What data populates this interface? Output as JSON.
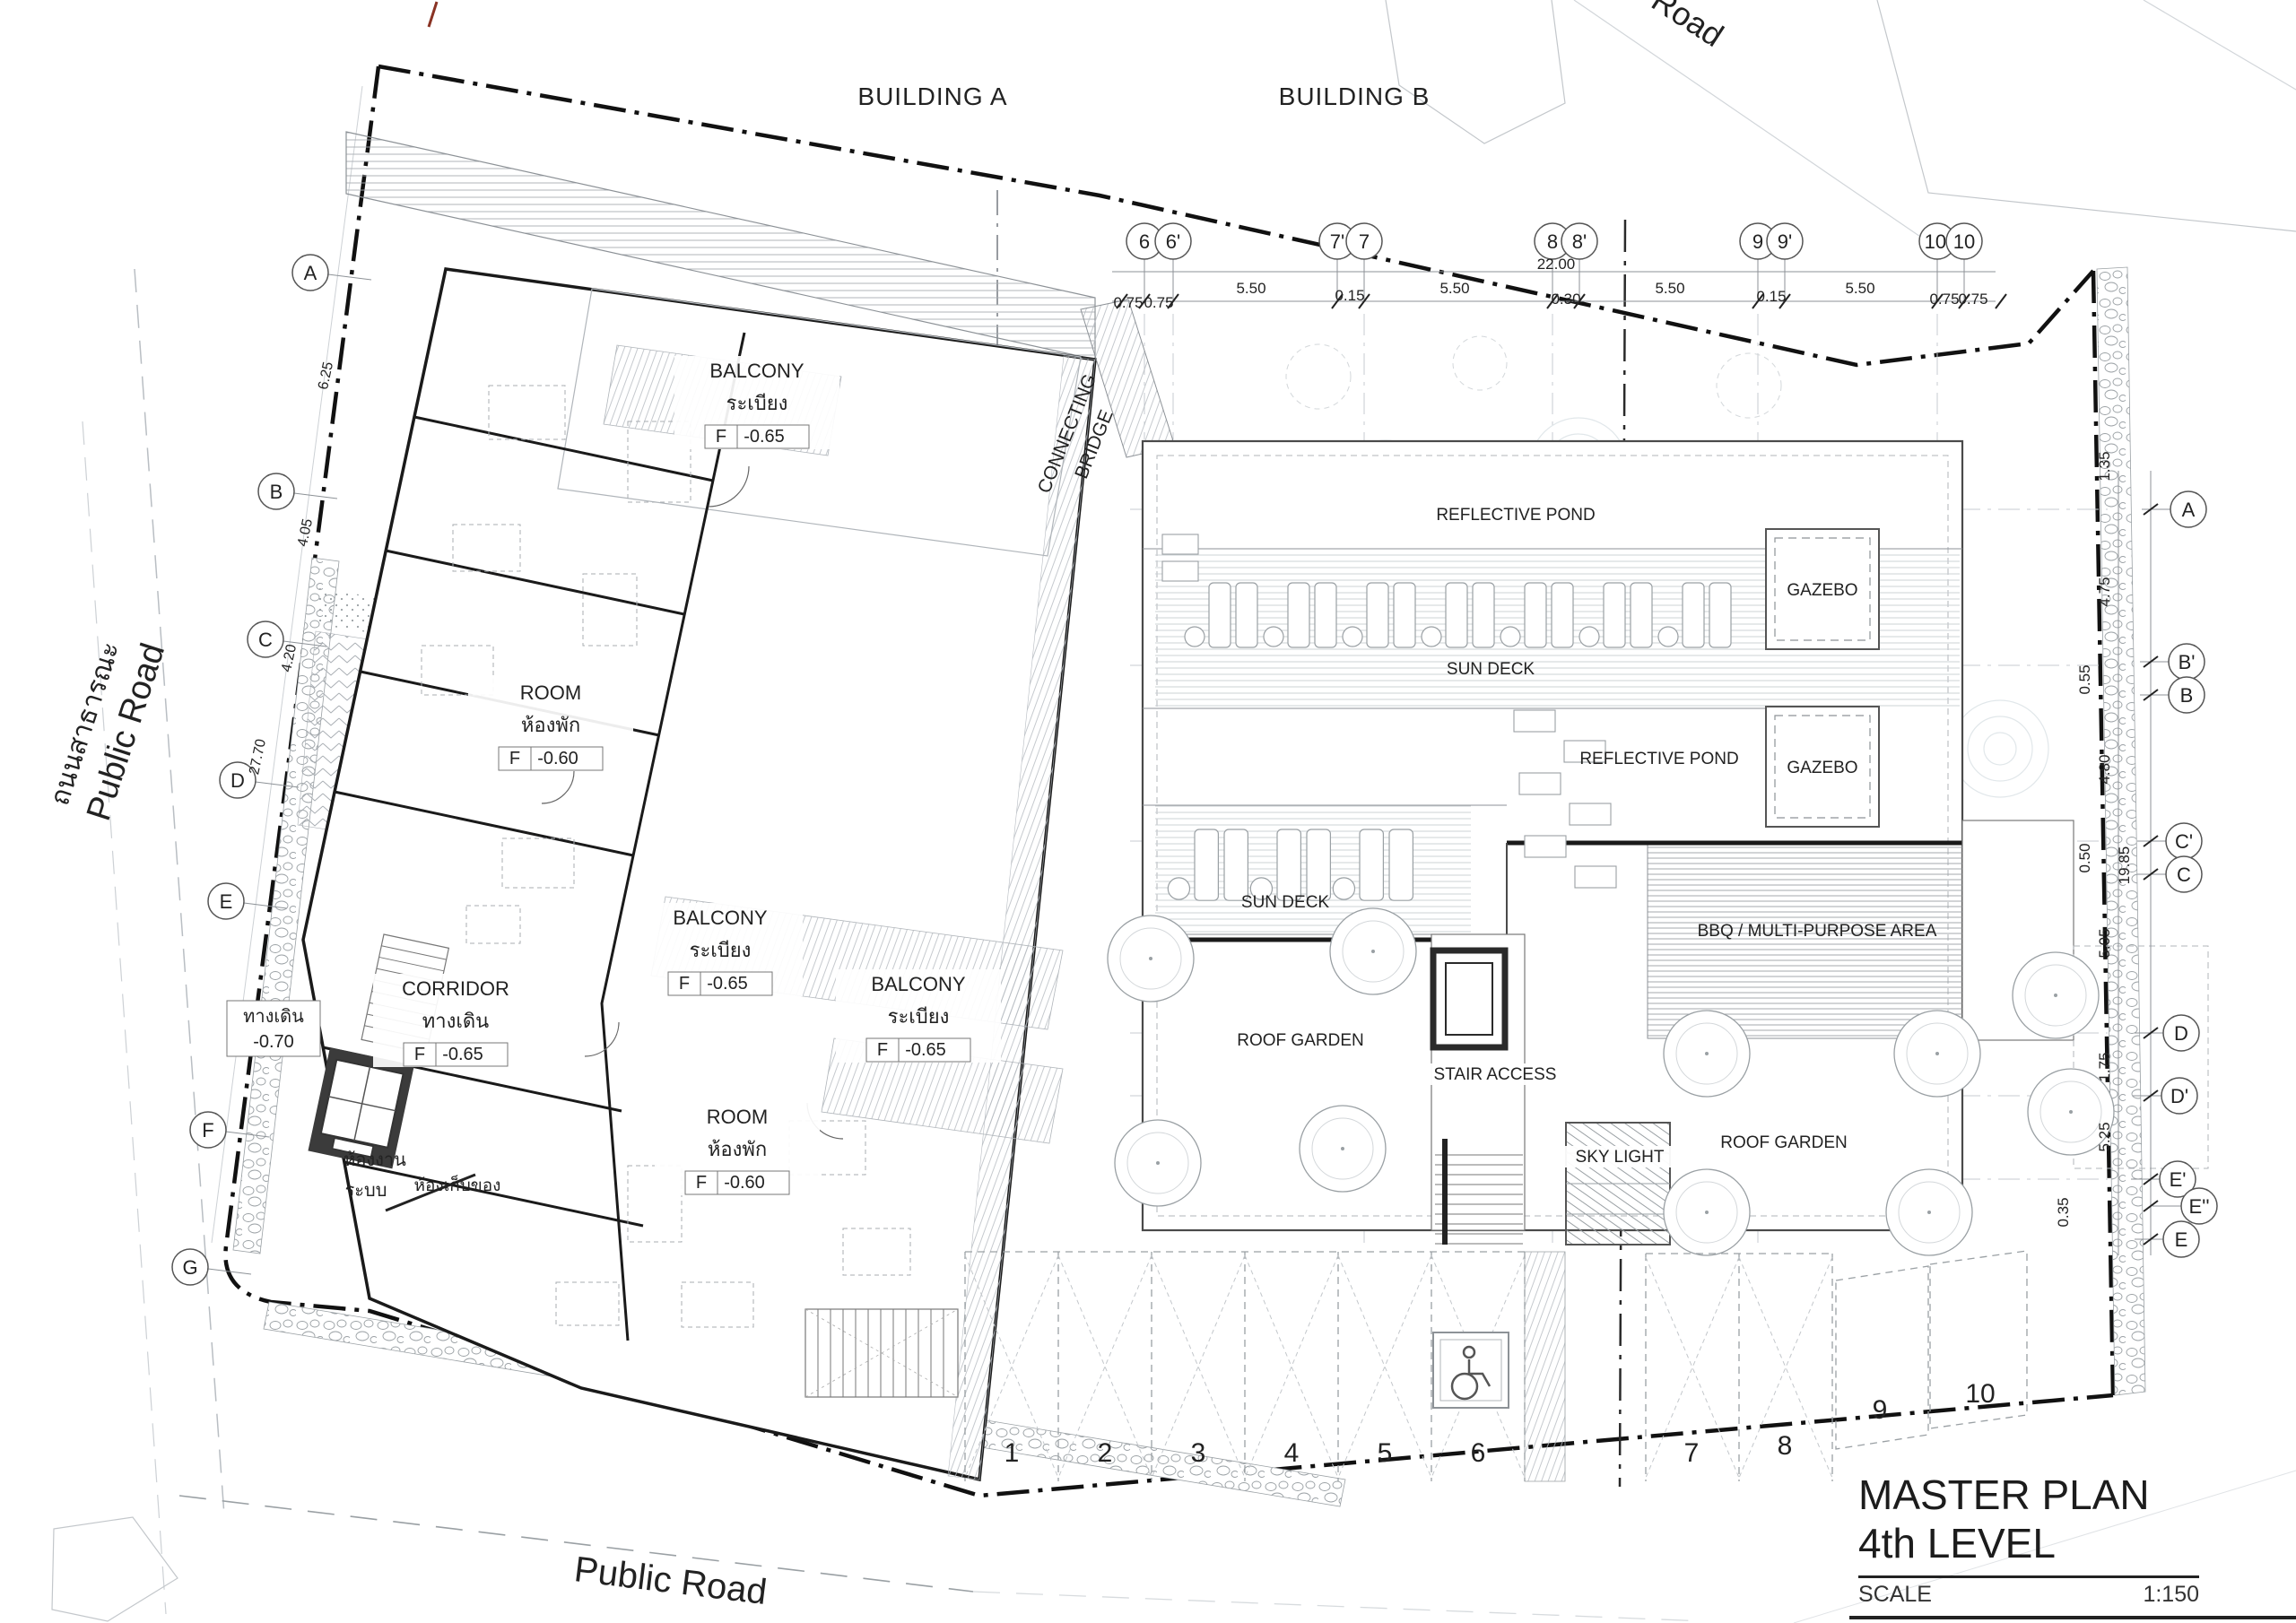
{
  "drawing": {
    "buildings": {
      "a": "BUILDING A",
      "b": "BUILDING B"
    },
    "roads": {
      "top": "Road",
      "left_thai": "ถนนสาธารณะ",
      "left_en": "Public Road",
      "bottom": "Public Road"
    },
    "labels": {
      "balcony": {
        "en": "BALCONY",
        "th": "ระเบียง",
        "f": "F",
        "lvl": "-0.65"
      },
      "room": {
        "en": "ROOM",
        "th": "ห้องพัก",
        "f": "F",
        "lvl": "-0.60"
      },
      "corridor": {
        "en": "CORRIDOR",
        "th": "ทางเดิน",
        "f": "F",
        "lvl": "-0.65"
      },
      "walkway": {
        "th": "ทางเดิน",
        "lvl": "-0.70"
      },
      "system_room_1": "ห้องงาน",
      "system_room_2": "ระบบ",
      "storage": "ห้องเก็บของ",
      "bridge_1": "CONNECTING",
      "bridge_2": "BRIDGE",
      "reflective_pond": "REFLECTIVE POND",
      "gazebo": "GAZEBO",
      "sun_deck": "SUN DECK",
      "bbq": "BBQ / MULTI-PURPOSE AREA",
      "roof_garden": "ROOF GARDEN",
      "stair_access": "STAIR ACCESS",
      "sky_light": "SKY LIGHT"
    },
    "grid": {
      "top": [
        "6",
        "6'",
        "7'",
        "7",
        "8",
        "8'",
        "9",
        "9'",
        "10'",
        "10"
      ],
      "left": [
        "A",
        "B",
        "C",
        "D",
        "E",
        "F",
        "G"
      ],
      "right": [
        "A",
        "B'",
        "B",
        "C'",
        "C",
        "D",
        "D'",
        "E'",
        "E''",
        "E"
      ]
    },
    "dimensions": {
      "top": [
        "0.75",
        "0.75",
        "5.50",
        "0.15",
        "5.50",
        "22.00",
        "0.30",
        "5.50",
        "0.15",
        "5.50",
        "0.75",
        "0.75"
      ],
      "right": [
        "1.35",
        "4.75",
        "0.55",
        "4.80",
        "0.50",
        "19.85",
        "5.05",
        "1.75",
        "5.25",
        "0.35"
      ],
      "left": [
        "6.25",
        "4.05",
        "4.20",
        "27.70"
      ]
    },
    "parking": {
      "numbers": [
        "1",
        "2",
        "3",
        "4",
        "5",
        "6",
        "7",
        "8",
        "9",
        "10"
      ],
      "accessible_icon": "wheelchair-icon"
    },
    "title_block": {
      "title_line1": "MASTER PLAN",
      "title_line2": "4th LEVEL",
      "scale_label": "SCALE",
      "scale_value": "1:150"
    }
  }
}
